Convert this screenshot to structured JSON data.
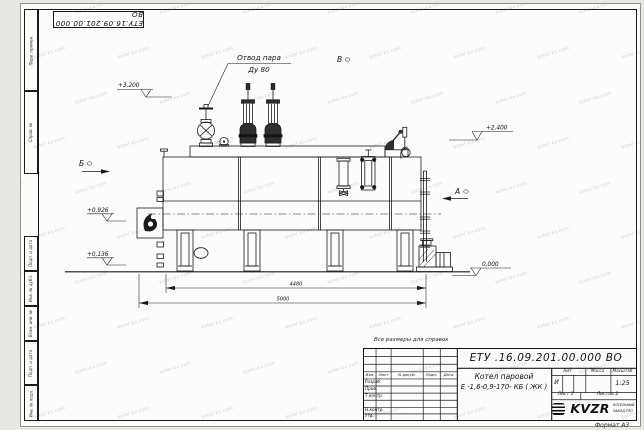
{
  "watermark": {
    "text": "kotel-kv.com"
  },
  "stamp_top": {
    "doc_number": "ЕТУ.16.09.201.00.000  ВО"
  },
  "margin_labels": {
    "perv_primen": "Перв. примен.",
    "sprav_no": "Справ. №",
    "podp_data_1": "Подп. и дата",
    "inv_dubl": "Инв. № дубл.",
    "vzam_inv": "Взам. инв. №",
    "podp_data_2": "Подп. и дата",
    "inv_podl": "Инв. № подл."
  },
  "annotations": {
    "steam_outlet_line1": "Отвод пара",
    "steam_outlet_line2": "Ду 80",
    "view_b": "Б",
    "view_v": "В",
    "view_a": "А",
    "elev_3200": "+3,200",
    "elev_2400": "+2,400",
    "elev_0926": "+0,926",
    "elev_0136": "+0,136",
    "elev_0000": "0,000",
    "dim_4480": "4480",
    "dim_5000": "5000"
  },
  "title_block": {
    "note_above": "Все размеры для справок",
    "doc_number": "ЕТУ .16.09.201.00.000  ВО",
    "product_line1": "Котел паровой",
    "product_line2": "Е -1,6-0,9-170- КБ ( ЖК )",
    "col_izm": "Изм.",
    "col_list": "Лист",
    "col_ndokum": "N докум.",
    "col_podp": "Подп.",
    "col_data": "Дата",
    "row_razrab": "Разраб.",
    "row_prov": "Пров.",
    "row_tkontr": "Т.контр.",
    "row_nkontr": "Н.контр.",
    "row_utv": "Утв.",
    "lit_header": "Лит.",
    "massa_header": "Масса",
    "masshtab_header": "Масштаб",
    "lit_value": "И",
    "scale_value": "1:25",
    "sheet_cell": "Лист 1",
    "sheets_cell": "Листов 2",
    "logo_text": "KVZR",
    "logo_sub_line1": "КОТЕЛЬНЫЙ",
    "logo_sub_line2": "ЗАВОД РЭП",
    "format_label": "Формат А3"
  }
}
